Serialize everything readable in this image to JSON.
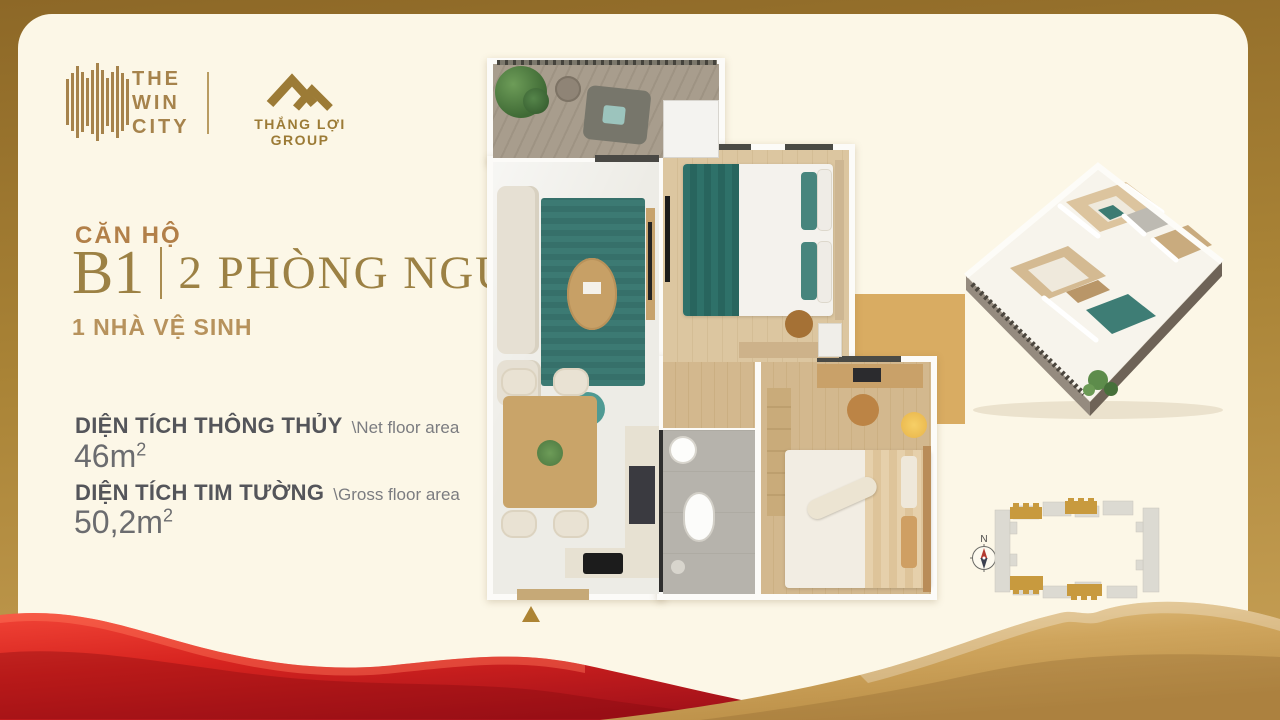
{
  "brand": {
    "win_city": [
      "THE",
      "WIN",
      "CITY"
    ],
    "developer": "THẮNG LỢI GROUP"
  },
  "unit": {
    "title": "CĂN HỘ",
    "code": "B1",
    "bedrooms": "2 PHÒNG NGỦ",
    "bathrooms": "1 NHÀ VỆ SINH"
  },
  "areas": {
    "net": {
      "label": "DIỆN TÍCH THÔNG THỦY",
      "sublabel": "\\Net floor area",
      "value": "46m",
      "sup": "2"
    },
    "gross": {
      "label": "DIỆN TÍCH TIM TƯỜNG",
      "sublabel": "\\Gross floor area",
      "value": "50,2m",
      "sup": "2"
    }
  },
  "site_plan": {
    "north": "N"
  },
  "colors": {
    "accent_gold": "#a6834c",
    "frame_gold": "#9a7329",
    "panel_cream": "#fcf7e7",
    "text_gray": "#54555a",
    "wave_red": "#d6231f",
    "wave_gold": "#cfa55d",
    "plan_teal": "#3c7a73",
    "highlight_unit_gold": "#c89a3e"
  }
}
